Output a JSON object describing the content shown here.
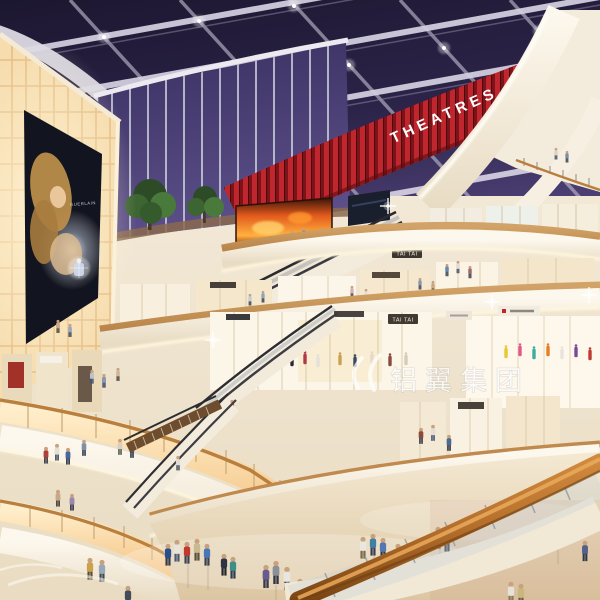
{
  "scene": {
    "kind": "shopping-mall-atrium-interior-rendering",
    "time_of_day": "dusk",
    "levels_visible": 5
  },
  "signs": {
    "theatres": "THEATRES",
    "tai_tai_upper": "TAI TAI",
    "tai_tai_lower": "TAI TAI",
    "billboard_brand": "GUERLAIN"
  },
  "watermark": {
    "text": "铝翼集团"
  },
  "colors": {
    "sky": "#2c2449",
    "beam": "#d6d2e2",
    "theatre_red": "#c0262e",
    "theatre_red_dark": "#7c1318",
    "fascia_cream": "#f4ede0",
    "wood": "#c79a5e",
    "glow_amber": "#ffd9a0",
    "lightbox_wall": "#f6dcae",
    "floor": "#e9d7ba",
    "handrail_wood": "#b26d2a",
    "fire_screen": "#e2591d"
  }
}
